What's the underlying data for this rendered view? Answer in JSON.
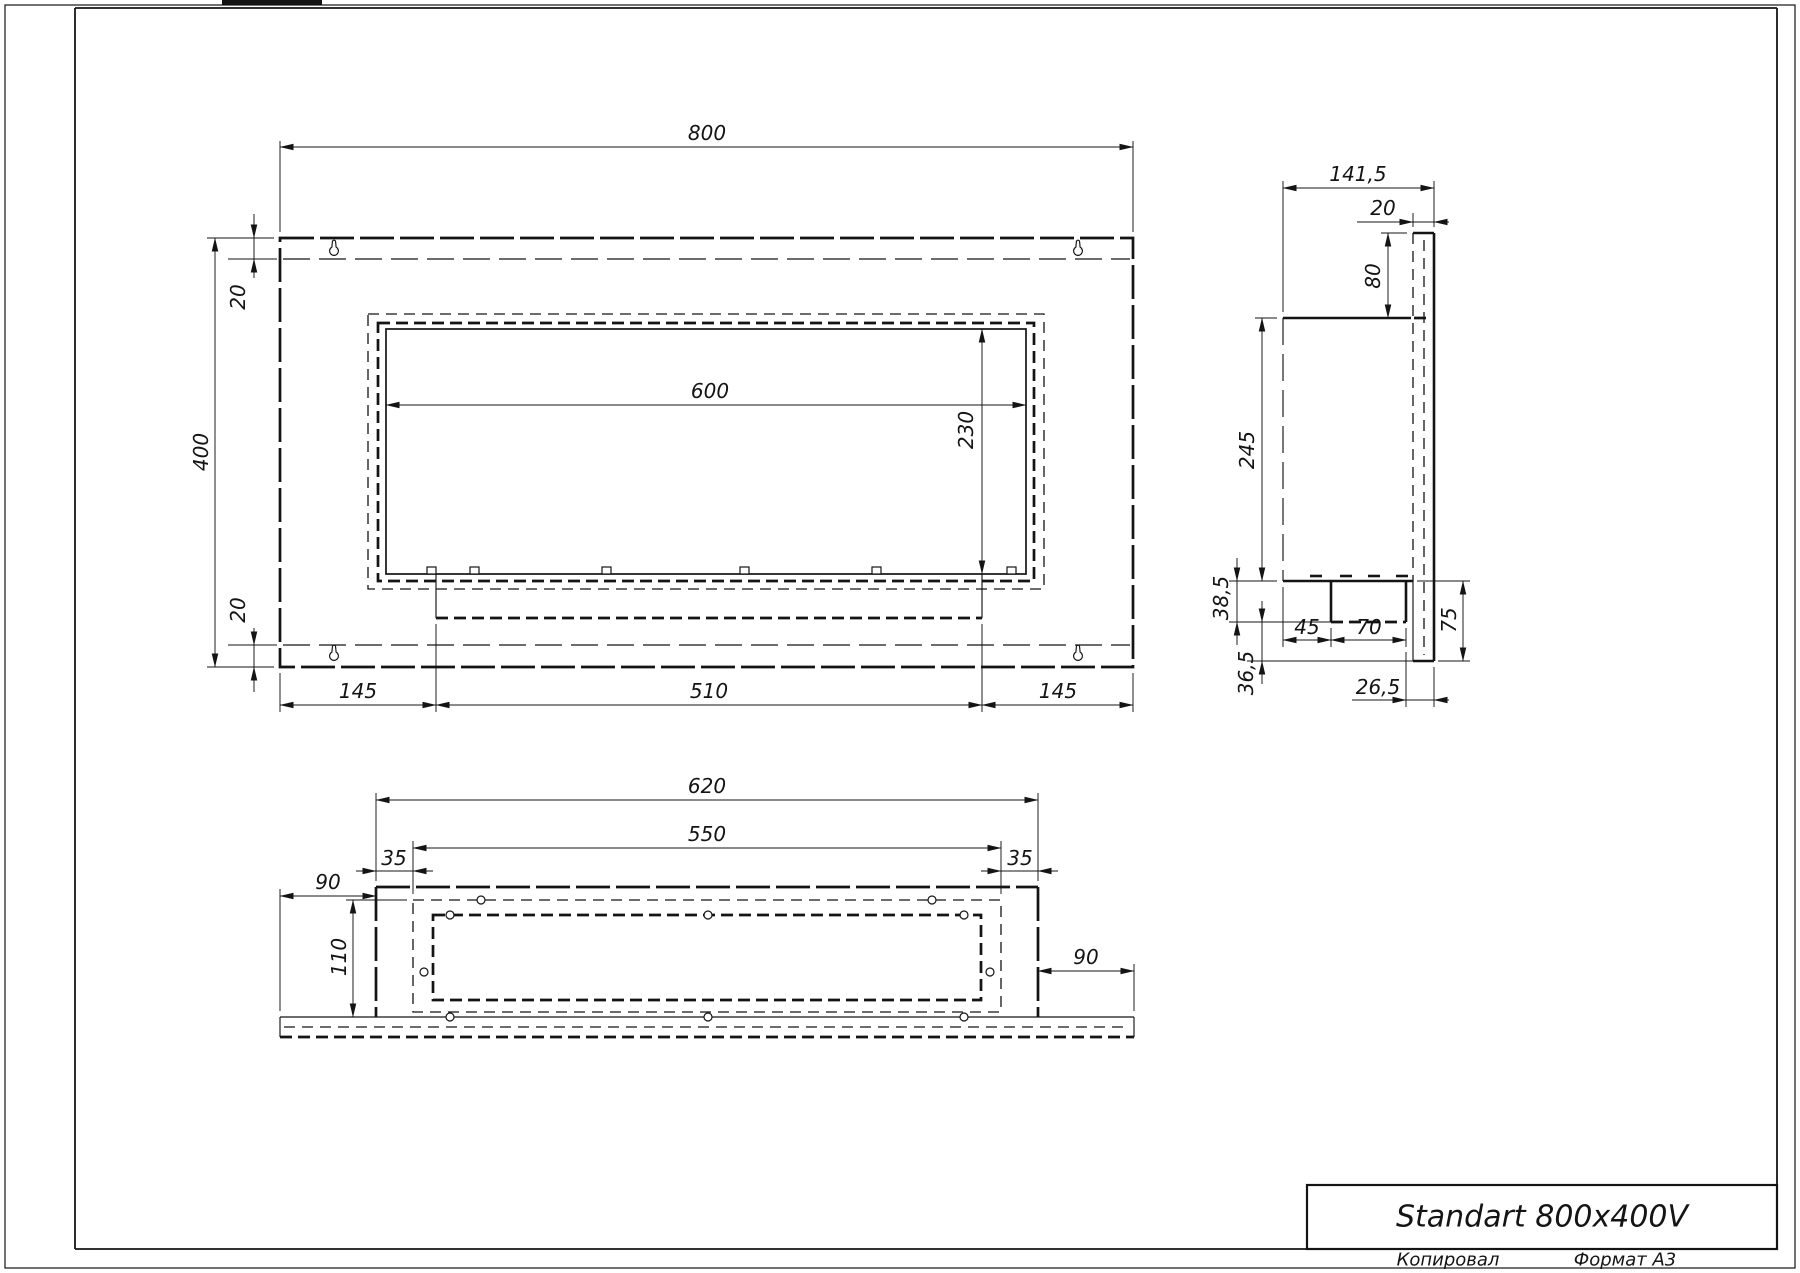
{
  "title_block": {
    "title": "Standart 800x400V"
  },
  "footer": {
    "copied_label": "Копировал",
    "format_label": "Формат А3"
  },
  "front_view": {
    "dims": {
      "width": "800",
      "height": "400",
      "fold_top": "20",
      "fold_bottom": "20",
      "opening_width": "600",
      "opening_height": "230",
      "bottom_left": "145",
      "bottom_center": "510",
      "bottom_right": "145"
    }
  },
  "side_view": {
    "dims": {
      "depth": "141,5",
      "panel_width": "20",
      "top_offset": "80",
      "body_height": "245",
      "burner_drop": "38,5",
      "bottom_gap": "36,5",
      "burner_left": "45",
      "burner_width": "70",
      "panel_drop": "75",
      "burner_to_edge": "26,5"
    }
  },
  "bottom_view": {
    "dims": {
      "outer_width": "620",
      "inner_width": "550",
      "margin_left": "35",
      "margin_right": "35",
      "flange_left": "90",
      "flange_right": "90",
      "depth": "110"
    }
  }
}
